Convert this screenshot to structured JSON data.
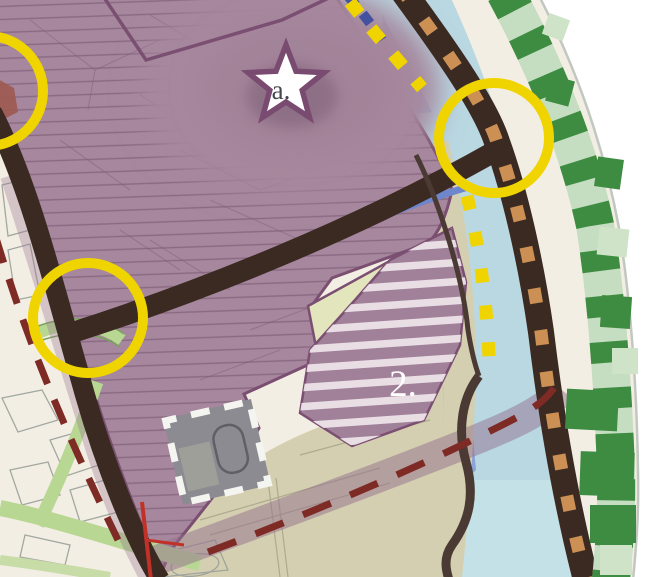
{
  "map": {
    "title": "masterplan-detail-view",
    "labels": {
      "star": "a.",
      "zone2": "2."
    },
    "icons": {
      "star_marker": "star",
      "highlight_circle": "circle-outline",
      "landmark_square": "dashed-square"
    },
    "colors": {
      "cream": "#f3eee3",
      "zone_purple": "#a6879d",
      "zone_purple_dark": "#a07f96",
      "zone_purple_border": "#7b4f72",
      "stripe_white": "#efe6ea",
      "water": "#b9d8e2",
      "water_medium": "#8fb6d9",
      "water_deep": "#8ba3d8",
      "water_cyan": "#c6e4e9",
      "canal_blue": "#6e86cc",
      "blue_dash": "#44519f",
      "road_dark": "#3a2a22",
      "road_secondary": "#4a3a33",
      "green_edge_light": "#c5ddc1",
      "green_edge_dark": "#3e8c41",
      "green_strip": "#b8d793",
      "beige": "#d5cfb1",
      "lime": "#e3e5bc",
      "highlight_yellow": "#f0d400",
      "route_orange": "#cc9055",
      "boundary_red": "#7e2a25",
      "red_line": "#c23128",
      "landmark_grey": "#8b8b91",
      "star_fill": "#ffffff",
      "label_dark": "#46464e",
      "label_light": "#ffffff",
      "edge_line": "#c2c8c1"
    }
  }
}
